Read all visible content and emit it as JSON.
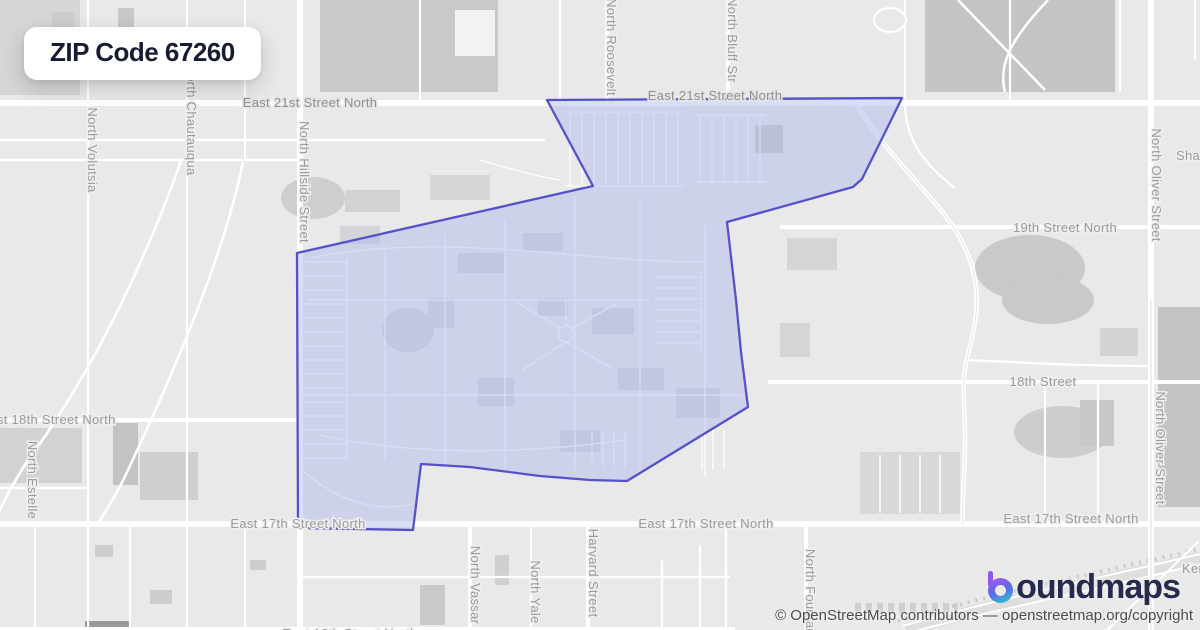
{
  "badge": {
    "title": "ZIP Code 67260"
  },
  "labels": {
    "e21_left": "East 21st Street North",
    "e21_right": "East 21st Street North",
    "s19": "19th Street North",
    "s18": "18th Street",
    "e18": "East 18th Street North",
    "e17_left": "East 17th Street North",
    "e17_mid": "East 17th Street North",
    "e17_right": "East 17th Street North",
    "e16": "East 16th Street North",
    "sha": "Sha",
    "kens": "Kens",
    "volutsia": "North Volutsia",
    "chautauqua": "North Chautauqua",
    "hillside": "North Hillside Street",
    "roosevelt": "North Roosevelt",
    "bluff": "North Bluff Str",
    "vassar": "North Vassar",
    "yale": "North Yale",
    "harvard": "Harvard Street",
    "fountain": "North Fountain",
    "oliver_upper": "North Oliver Street",
    "oliver_lower": "North Oliver Street",
    "estelle": "North Estelle"
  },
  "boundary": {
    "zip": "67260",
    "points": [
      [
        547,
        100
      ],
      [
        902,
        98
      ],
      [
        862,
        179
      ],
      [
        853,
        187
      ],
      [
        727,
        222
      ],
      [
        736,
        300
      ],
      [
        741,
        352
      ],
      [
        748,
        407
      ],
      [
        627,
        481
      ],
      [
        590,
        480
      ],
      [
        540,
        476
      ],
      [
        470,
        467
      ],
      [
        421,
        464
      ],
      [
        413,
        530
      ],
      [
        298,
        528
      ],
      [
        297,
        253
      ],
      [
        593,
        186
      ]
    ]
  },
  "logo": {
    "icon": "boundmaps-gradient-b-icon",
    "wordmark": "oundmaps",
    "full_name": "boundmaps"
  },
  "attribution": {
    "text": "© OpenStreetMap contributors — openstreetmap.org/copyright"
  },
  "colors": {
    "map_bg": "#e9e9e9",
    "road": "#ffffff",
    "street_label": "#9a9a9a",
    "boundary_stroke": "#5552c9",
    "boundary_fill": "#aab3ea",
    "badge_text": "#171c33",
    "logo_text": "#262a4e",
    "logo_gradient_top": "#a159f2",
    "logo_gradient_bottom": "#31c4cd"
  }
}
